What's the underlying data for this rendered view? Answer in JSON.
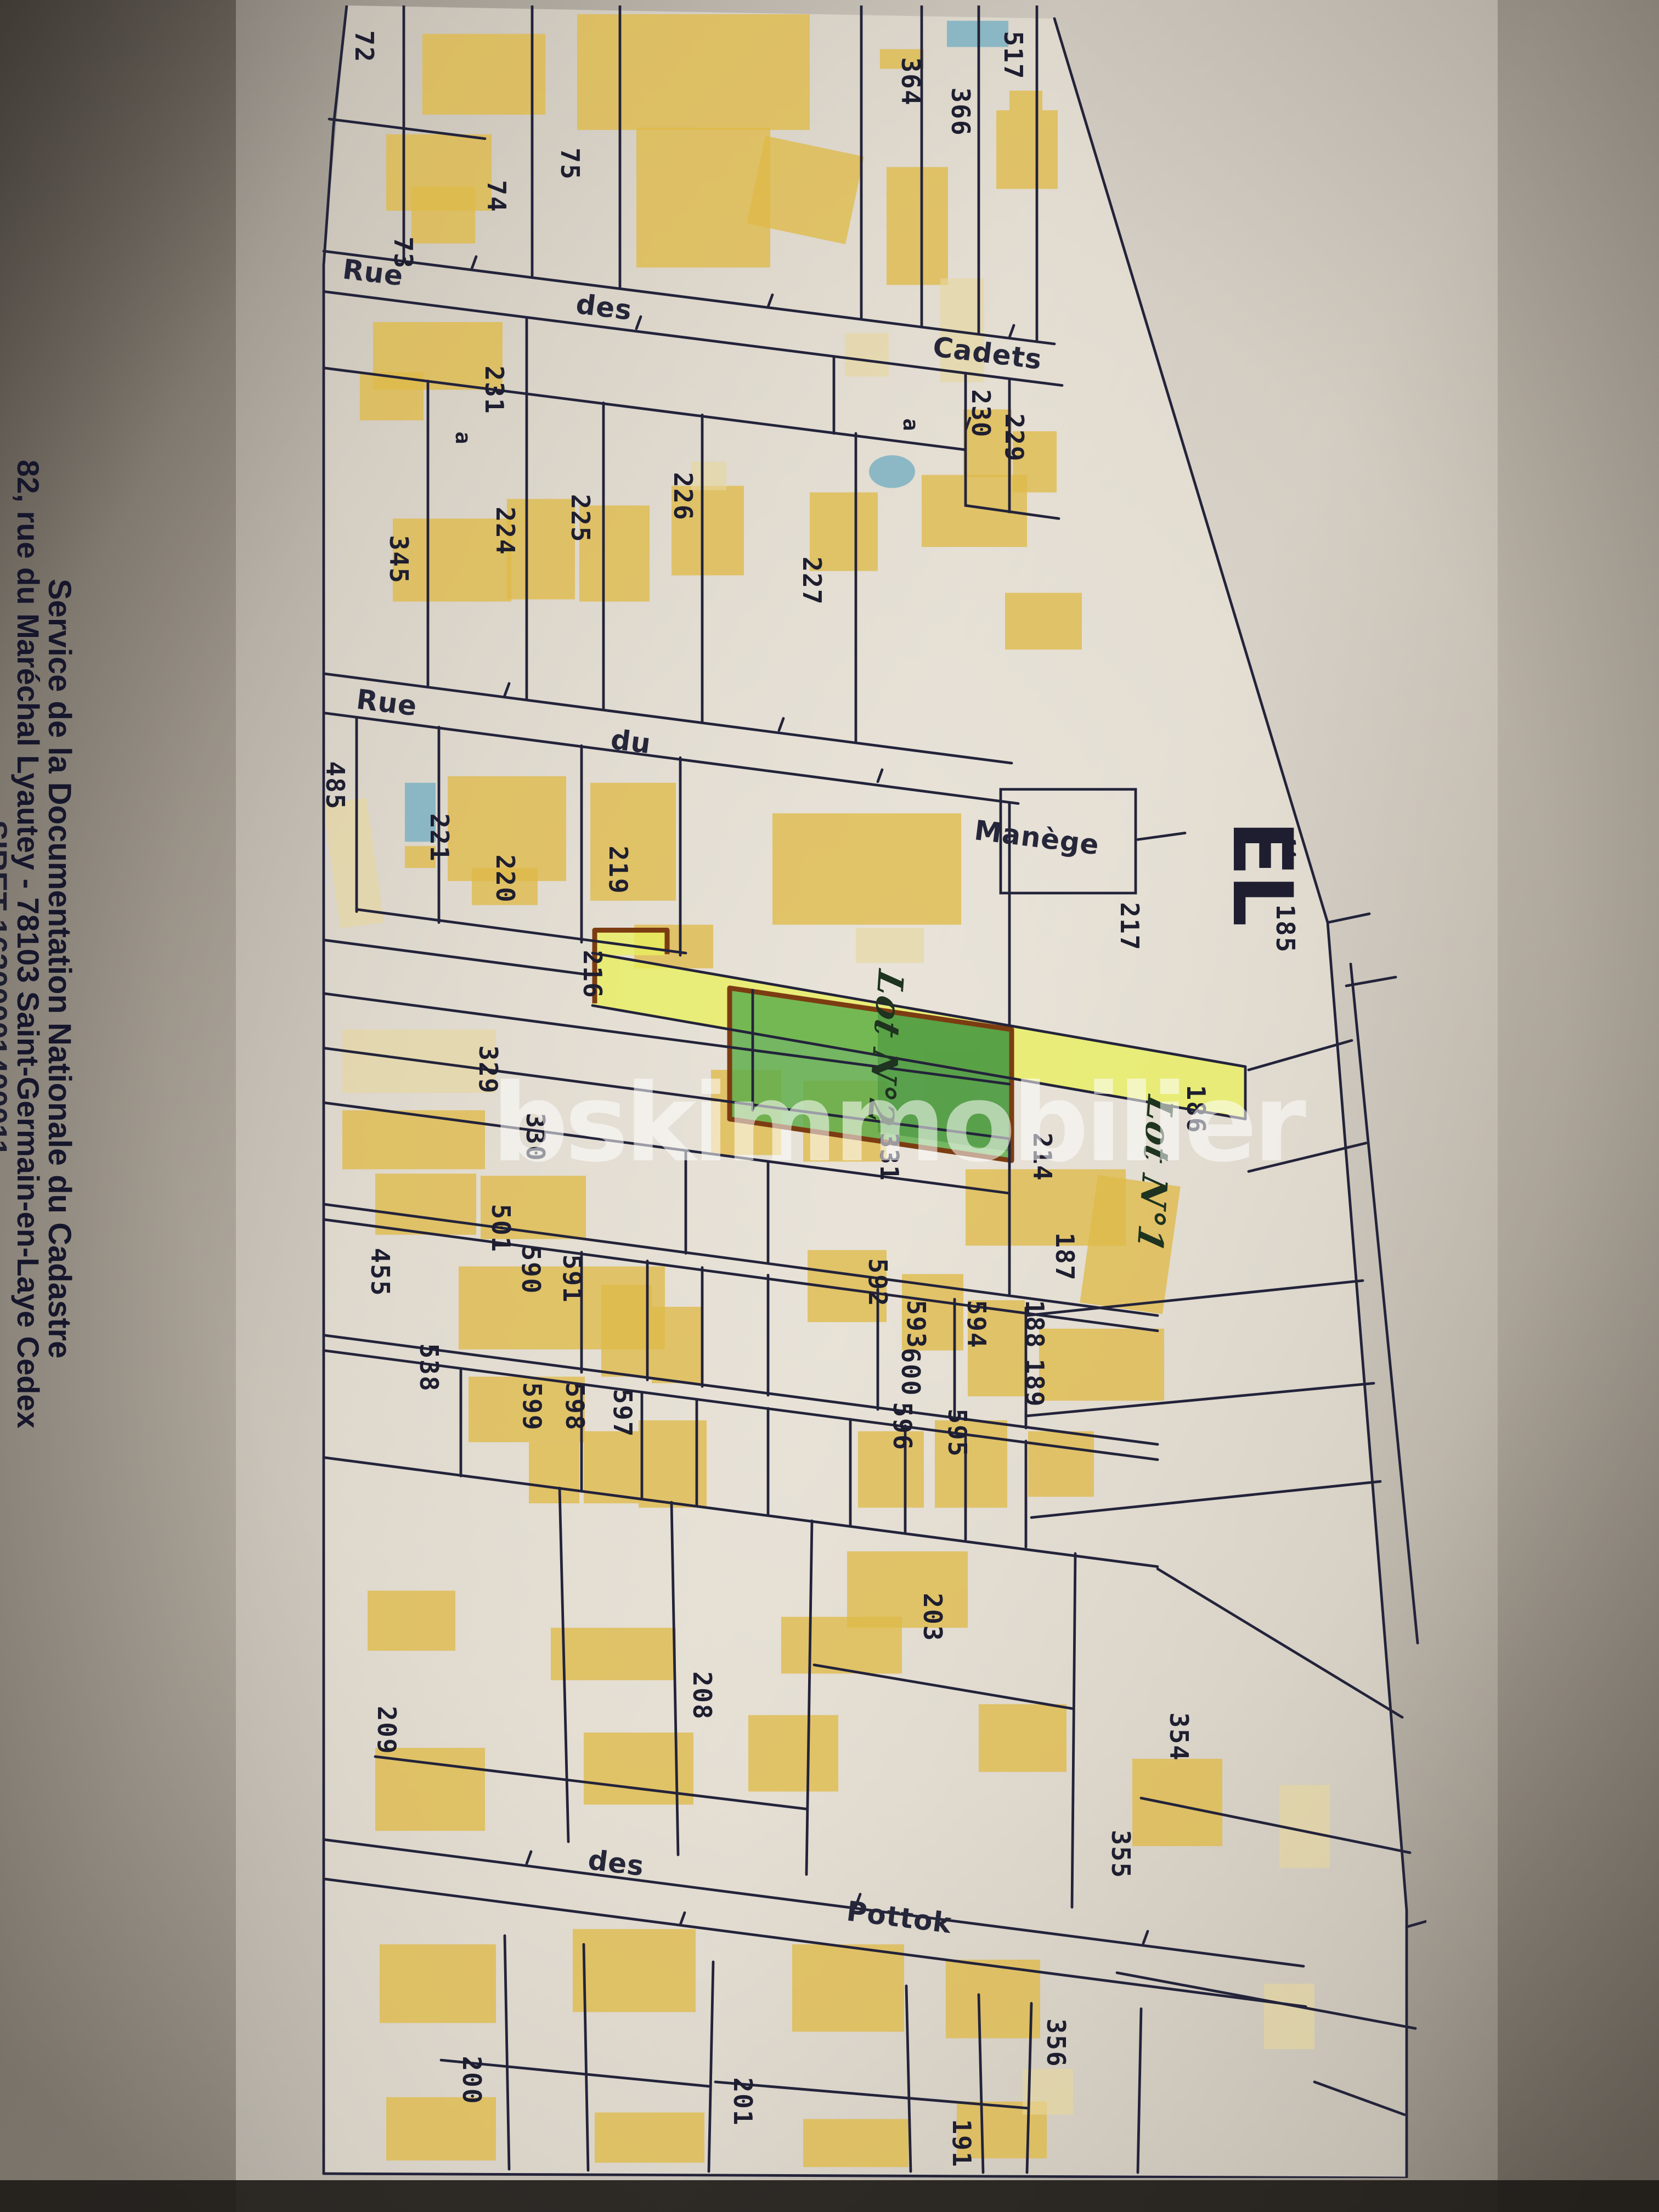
{
  "document_type": "cadastral map photograph",
  "sender": {
    "line1": "Service de la Documentation Nationale du Cadastre",
    "line2": "82, rue du Maréchal Lyautey - 78103 Saint-Germain-en-Laye Cedex",
    "line3_partial": "SIRET 16300001400011"
  },
  "watermark": {
    "text": "bskimmobilier",
    "logo": "house-outline-logo"
  },
  "colors": {
    "ink": "#23233a",
    "building": "#dfba49",
    "building_light": "#e7d69c",
    "pool": "#82b4c3",
    "highlight_yellow": "#e9ef5e",
    "highlight_green": "#5fae4c",
    "outline_brown": "#7c3c12",
    "handwriting": "#1e3320",
    "watermark": "#ffffff"
  },
  "map": {
    "sheet_label": "EL",
    "streets": [
      "Rue des Cadets",
      "Rue du Manège",
      "des Pottok"
    ],
    "highlighted_lots": [
      {
        "label": "Lot N°1",
        "style": "yellow highlighted strip"
      },
      {
        "label": "Lot N°2",
        "style": "green highlighted block with brown outline"
      }
    ],
    "parcel_numbers": [
      "72",
      "73",
      "74",
      "75",
      "364",
      "366",
      "517",
      "229",
      "230",
      "231",
      "224",
      "225",
      "226",
      "227",
      "345",
      "485",
      "221",
      "220",
      "219",
      "216",
      "217",
      "214",
      "185",
      "186",
      "187",
      "188",
      "189",
      "329",
      "330",
      "331",
      "501",
      "455",
      "538",
      "590",
      "591",
      "592",
      "593",
      "594",
      "595",
      "596",
      "597",
      "598",
      "599",
      "600",
      "203",
      "208",
      "209",
      "354",
      "355",
      "356",
      "200",
      "201",
      "191"
    ],
    "labels": [
      {
        "name": "parcel-label-72",
        "text": "72",
        "x": 5.1,
        "y": 1.9,
        "kind": "parcel"
      },
      {
        "name": "parcel-label-73",
        "text": "73",
        "x": 8.6,
        "y": 11.4,
        "kind": "parcel"
      },
      {
        "name": "parcel-label-74",
        "text": "74",
        "x": 16.9,
        "y": 8.8,
        "kind": "parcel"
      },
      {
        "name": "parcel-label-75",
        "text": "75",
        "x": 23.5,
        "y": 7.3,
        "kind": "parcel"
      },
      {
        "name": "parcel-label-364",
        "text": "364",
        "x": 53.9,
        "y": 3.5,
        "kind": "parcel"
      },
      {
        "name": "parcel-label-366",
        "text": "366",
        "x": 58.4,
        "y": 4.9,
        "kind": "parcel"
      },
      {
        "name": "parcel-label-517",
        "text": "517",
        "x": 63.1,
        "y": 2.3,
        "kind": "parcel"
      },
      {
        "name": "street-word-rue-cadets",
        "text": "Rue",
        "x": 5.9,
        "y": 12.3,
        "kind": "street"
      },
      {
        "name": "street-word-des-cadets",
        "text": "des",
        "x": 26.5,
        "y": 13.9,
        "kind": "street"
      },
      {
        "name": "street-word-cadets",
        "text": "Cadets",
        "x": 60.8,
        "y": 16.0,
        "kind": "street"
      },
      {
        "name": "parcel-label-231",
        "text": "231",
        "x": 16.7,
        "y": 17.7,
        "kind": "parcel"
      },
      {
        "name": "sub-label-a-1",
        "text": "a",
        "x": 13.9,
        "y": 19.9,
        "kind": "sub"
      },
      {
        "name": "sub-label-a-2",
        "text": "a",
        "x": 53.9,
        "y": 19.3,
        "kind": "sub"
      },
      {
        "name": "parcel-label-230",
        "text": "230",
        "x": 60.2,
        "y": 18.8,
        "kind": "parcel"
      },
      {
        "name": "parcel-label-229",
        "text": "229",
        "x": 63.2,
        "y": 19.9,
        "kind": "parcel"
      },
      {
        "name": "parcel-label-345",
        "text": "345",
        "x": 8.2,
        "y": 25.5,
        "kind": "parcel"
      },
      {
        "name": "parcel-label-224",
        "text": "224",
        "x": 17.7,
        "y": 24.2,
        "kind": "parcel"
      },
      {
        "name": "parcel-label-225",
        "text": "225",
        "x": 24.4,
        "y": 23.6,
        "kind": "parcel"
      },
      {
        "name": "parcel-label-226",
        "text": "226",
        "x": 33.6,
        "y": 22.6,
        "kind": "parcel"
      },
      {
        "name": "parcel-label-227",
        "text": "227",
        "x": 45.1,
        "y": 26.5,
        "kind": "parcel"
      },
      {
        "name": "street-word-rue-manege",
        "text": "Rue",
        "x": 7.1,
        "y": 32.1,
        "kind": "street"
      },
      {
        "name": "street-word-du-manege",
        "text": "du",
        "x": 28.9,
        "y": 33.9,
        "kind": "street"
      },
      {
        "name": "parcel-label-manege",
        "text": "Manège",
        "x": 65.2,
        "y": 38.3,
        "kind": "street"
      },
      {
        "name": "parcel-label-485",
        "text": "485",
        "x": 2.5,
        "y": 35.9,
        "kind": "parcel"
      },
      {
        "name": "parcel-label-221",
        "text": "221",
        "x": 11.8,
        "y": 38.3,
        "kind": "parcel"
      },
      {
        "name": "parcel-label-220",
        "text": "220",
        "x": 17.7,
        "y": 40.2,
        "kind": "parcel"
      },
      {
        "name": "parcel-label-219",
        "text": "219",
        "x": 27.8,
        "y": 39.8,
        "kind": "parcel"
      },
      {
        "name": "parcel-label-216",
        "text": "216",
        "x": 25.5,
        "y": 44.6,
        "kind": "parcel"
      },
      {
        "name": "parcel-label-217",
        "text": "217",
        "x": 73.5,
        "y": 42.4,
        "kind": "parcel"
      },
      {
        "name": "sheet-label-el",
        "text": "EL",
        "x": 85.3,
        "y": 39.9,
        "kind": "sheet"
      },
      {
        "name": "tick-label-14",
        "text": "14",
        "x": 87.7,
        "y": 38.8,
        "kind": "tick"
      },
      {
        "name": "parcel-label-185",
        "text": "185",
        "x": 87.4,
        "y": 42.5,
        "kind": "parcel"
      },
      {
        "name": "parcel-label-186",
        "text": "186",
        "x": 79.4,
        "y": 50.8,
        "kind": "parcel"
      },
      {
        "name": "hand-label-lot-1",
        "text": "Lot N°1",
        "x": 75.7,
        "y": 53.8,
        "kind": "hand"
      },
      {
        "name": "hand-label-lot-2",
        "text": "Lot N°2",
        "x": 51.6,
        "y": 48.0,
        "kind": "hand"
      },
      {
        "name": "parcel-label-329",
        "text": "329",
        "x": 16.2,
        "y": 49.0,
        "kind": "parcel"
      },
      {
        "name": "parcel-label-330",
        "text": "330",
        "x": 20.4,
        "y": 52.1,
        "kind": "parcel"
      },
      {
        "name": "parcel-label-331",
        "text": "331",
        "x": 52.0,
        "y": 53.0,
        "kind": "parcel"
      },
      {
        "name": "parcel-label-214",
        "text": "214",
        "x": 65.7,
        "y": 53.0,
        "kind": "parcel"
      },
      {
        "name": "parcel-label-187",
        "text": "187",
        "x": 67.7,
        "y": 57.6,
        "kind": "parcel"
      },
      {
        "name": "parcel-label-188",
        "text": "188",
        "x": 65.0,
        "y": 60.7,
        "kind": "parcel"
      },
      {
        "name": "parcel-label-189",
        "text": "189",
        "x": 65.0,
        "y": 63.4,
        "kind": "parcel"
      },
      {
        "name": "parcel-label-501",
        "text": "501",
        "x": 17.3,
        "y": 56.3,
        "kind": "parcel"
      },
      {
        "name": "parcel-label-455",
        "text": "455",
        "x": 6.5,
        "y": 58.3,
        "kind": "parcel"
      },
      {
        "name": "parcel-label-590",
        "text": "590",
        "x": 20.0,
        "y": 58.2,
        "kind": "parcel"
      },
      {
        "name": "parcel-label-591",
        "text": "591",
        "x": 23.7,
        "y": 58.6,
        "kind": "parcel"
      },
      {
        "name": "parcel-label-592",
        "text": "592",
        "x": 51.0,
        "y": 58.8,
        "kind": "parcel"
      },
      {
        "name": "parcel-label-593",
        "text": "593",
        "x": 54.4,
        "y": 60.7,
        "kind": "parcel"
      },
      {
        "name": "parcel-label-594",
        "text": "594",
        "x": 59.8,
        "y": 60.7,
        "kind": "parcel"
      },
      {
        "name": "parcel-label-600",
        "text": "600",
        "x": 53.9,
        "y": 62.9,
        "kind": "parcel"
      },
      {
        "name": "parcel-label-596",
        "text": "596",
        "x": 53.2,
        "y": 65.4,
        "kind": "parcel"
      },
      {
        "name": "parcel-label-595",
        "text": "595",
        "x": 58.1,
        "y": 65.7,
        "kind": "parcel"
      },
      {
        "name": "parcel-label-597",
        "text": "597",
        "x": 28.2,
        "y": 64.8,
        "kind": "parcel"
      },
      {
        "name": "parcel-label-598",
        "text": "598",
        "x": 23.9,
        "y": 64.5,
        "kind": "parcel"
      },
      {
        "name": "parcel-label-599",
        "text": "599",
        "x": 20.1,
        "y": 64.5,
        "kind": "parcel"
      },
      {
        "name": "parcel-label-538",
        "text": "538",
        "x": 10.9,
        "y": 62.7,
        "kind": "parcel"
      },
      {
        "name": "parcel-label-203",
        "text": "203",
        "x": 55.9,
        "y": 74.2,
        "kind": "parcel"
      },
      {
        "name": "parcel-label-209",
        "text": "209",
        "x": 7.1,
        "y": 79.4,
        "kind": "parcel"
      },
      {
        "name": "parcel-label-208",
        "text": "208",
        "x": 35.3,
        "y": 77.8,
        "kind": "parcel"
      },
      {
        "name": "parcel-label-354",
        "text": "354",
        "x": 77.9,
        "y": 79.7,
        "kind": "parcel"
      },
      {
        "name": "parcel-label-355",
        "text": "355",
        "x": 72.7,
        "y": 85.1,
        "kind": "parcel"
      },
      {
        "name": "parcel-label-356",
        "text": "356",
        "x": 66.9,
        "y": 93.8,
        "kind": "parcel"
      },
      {
        "name": "street-word-des-pottok",
        "text": "des",
        "x": 27.6,
        "y": 85.5,
        "kind": "street"
      },
      {
        "name": "street-word-pottok",
        "text": "Pottok",
        "x": 52.9,
        "y": 88.0,
        "kind": "street"
      },
      {
        "name": "parcel-label-200",
        "text": "200",
        "x": 14.7,
        "y": 95.5,
        "kind": "parcel"
      },
      {
        "name": "parcel-label-201",
        "text": "201",
        "x": 38.9,
        "y": 96.5,
        "kind": "parcel"
      },
      {
        "name": "parcel-label-191",
        "text": "191",
        "x": 58.5,
        "y": 98.4,
        "kind": "parcel"
      }
    ]
  }
}
